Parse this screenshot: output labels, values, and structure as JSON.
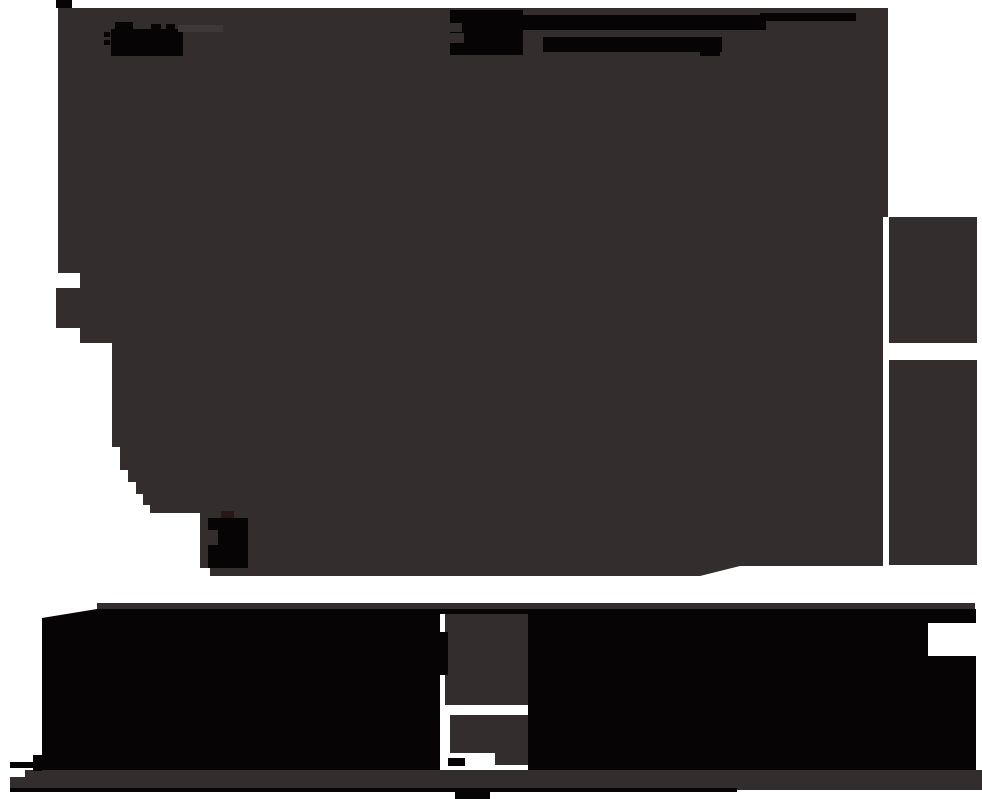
{
  "canvas": {
    "width": 982,
    "height": 799,
    "background": "#ffffff"
  },
  "palette": {
    "white": "#ffffff",
    "surface": "#332d2d",
    "ink": "#060404",
    "ink_warm": "#2a1616",
    "highlight": "#3e3838"
  },
  "shapes": [
    {
      "name": "main-dark-mass",
      "type": "path",
      "fill": "surface",
      "d": "M58,8 H888 V217 H883 V566 L740,566 L700,576 L210,576 L210,568 L200,568 L200,513 L150,513 L150,505 L143,505 L143,494 L136,494 L136,482 L128,482 L128,470 L120,470 L120,447 L112,447 L112,343 L80,343 L80,328 L56,328 L56,288 L80,288 L80,273 L58,273 Z"
    },
    {
      "name": "right-panel-upper",
      "type": "rect",
      "fill": "surface",
      "x": 889,
      "y": 217,
      "w": 88,
      "h": 126
    },
    {
      "name": "right-panel-lower",
      "type": "rect",
      "fill": "surface",
      "x": 889,
      "y": 360,
      "w": 88,
      "h": 205
    },
    {
      "name": "top-left-corner-nub",
      "type": "rect",
      "fill": "ink",
      "x": 56,
      "y": 0,
      "w": 16,
      "h": 8
    },
    {
      "name": "logo-smear-body",
      "type": "rect",
      "fill": "ink",
      "x": 111,
      "y": 29,
      "w": 72,
      "h": 27
    },
    {
      "name": "logo-smear-bump-1",
      "type": "rect",
      "fill": "ink",
      "x": 115,
      "y": 22,
      "w": 18,
      "h": 8
    },
    {
      "name": "logo-smear-bump-2",
      "type": "rect",
      "fill": "ink",
      "x": 151,
      "y": 24,
      "w": 10,
      "h": 6
    },
    {
      "name": "logo-smear-bump-3",
      "type": "rect",
      "fill": "ink",
      "x": 166,
      "y": 24,
      "w": 9,
      "h": 6
    },
    {
      "name": "logo-smear-dash-1",
      "type": "rect",
      "fill": "ink",
      "x": 104,
      "y": 32,
      "w": 6,
      "h": 5
    },
    {
      "name": "logo-smear-dash-2",
      "type": "rect",
      "fill": "ink",
      "x": 104,
      "y": 40,
      "w": 6,
      "h": 5
    },
    {
      "name": "logo-highlight-bar",
      "type": "rect",
      "fill": "highlight",
      "x": 178,
      "y": 25,
      "w": 45,
      "h": 7
    },
    {
      "name": "nav-smear-blob",
      "type": "rect",
      "fill": "ink",
      "x": 450,
      "y": 10,
      "w": 73,
      "h": 45
    },
    {
      "name": "nav-smear-blob-notch-1",
      "type": "rect",
      "fill": "surface",
      "x": 450,
      "y": 23,
      "w": 12,
      "h": 9
    },
    {
      "name": "nav-smear-blob-notch-2",
      "type": "rect",
      "fill": "surface",
      "x": 450,
      "y": 33,
      "w": 14,
      "h": 10
    },
    {
      "name": "nav-smear-1",
      "type": "rect",
      "fill": "ink",
      "x": 522,
      "y": 15,
      "w": 244,
      "h": 15
    },
    {
      "name": "nav-smear-2",
      "type": "rect",
      "fill": "ink",
      "x": 543,
      "y": 37,
      "w": 179,
      "h": 15
    },
    {
      "name": "nav-smear-3",
      "type": "rect",
      "fill": "ink",
      "x": 760,
      "y": 13,
      "w": 96,
      "h": 8
    },
    {
      "name": "nav-smear-4",
      "type": "rect",
      "fill": "ink",
      "x": 700,
      "y": 49,
      "w": 20,
      "h": 7
    },
    {
      "name": "glyph-blob-body",
      "type": "rect",
      "fill": "ink",
      "x": 208,
      "y": 518,
      "w": 40,
      "h": 50
    },
    {
      "name": "glyph-blob-bump",
      "type": "rect",
      "fill": "ink_warm",
      "x": 221,
      "y": 511,
      "w": 13,
      "h": 7
    },
    {
      "name": "glyph-blob-notch",
      "type": "rect",
      "fill": "surface",
      "x": 208,
      "y": 530,
      "w": 10,
      "h": 15
    },
    {
      "name": "lower-strip",
      "type": "rect",
      "fill": "surface",
      "x": 97,
      "y": 603,
      "w": 878,
      "h": 7
    },
    {
      "name": "lower-black-mass",
      "type": "path",
      "fill": "ink",
      "d": "M42,618 L97,609 H976 V773 H42 Z"
    },
    {
      "name": "lower-mass-notch",
      "type": "rect",
      "fill": "white",
      "x": 928,
      "y": 623,
      "w": 48,
      "h": 33
    },
    {
      "name": "pillar-bay",
      "type": "rect",
      "fill": "white",
      "x": 440,
      "y": 614,
      "w": 88,
      "h": 159
    },
    {
      "name": "pillar-upper",
      "type": "rect",
      "fill": "surface",
      "x": 445,
      "y": 614,
      "w": 83,
      "h": 91
    },
    {
      "name": "pillar-lower",
      "type": "rect",
      "fill": "surface",
      "x": 450,
      "y": 715,
      "w": 78,
      "h": 38
    },
    {
      "name": "pillar-extension",
      "type": "rect",
      "fill": "surface",
      "x": 495,
      "y": 750,
      "w": 33,
      "h": 15
    },
    {
      "name": "pillar-edge-mark",
      "type": "rect",
      "fill": "ink",
      "x": 440,
      "y": 632,
      "w": 8,
      "h": 43
    },
    {
      "name": "pillar-dash",
      "type": "rect",
      "fill": "ink",
      "x": 448,
      "y": 758,
      "w": 17,
      "h": 8
    },
    {
      "name": "paragraph-band",
      "type": "path",
      "fill": "surface",
      "d": "M25,770 H982 V790 H10 V777 H25 Z"
    },
    {
      "name": "underline-rule",
      "type": "rect",
      "fill": "ink",
      "x": 10,
      "y": 788,
      "w": 727,
      "h": 4
    },
    {
      "name": "bottom-center-blob",
      "type": "rect",
      "fill": "ink",
      "x": 455,
      "y": 790,
      "w": 35,
      "h": 9
    },
    {
      "name": "bottom-left-dash",
      "type": "rect",
      "fill": "ink",
      "x": 10,
      "y": 762,
      "w": 30,
      "h": 6
    },
    {
      "name": "bottom-left-nub",
      "type": "rect",
      "fill": "ink",
      "x": 33,
      "y": 755,
      "w": 9,
      "h": 16
    }
  ]
}
